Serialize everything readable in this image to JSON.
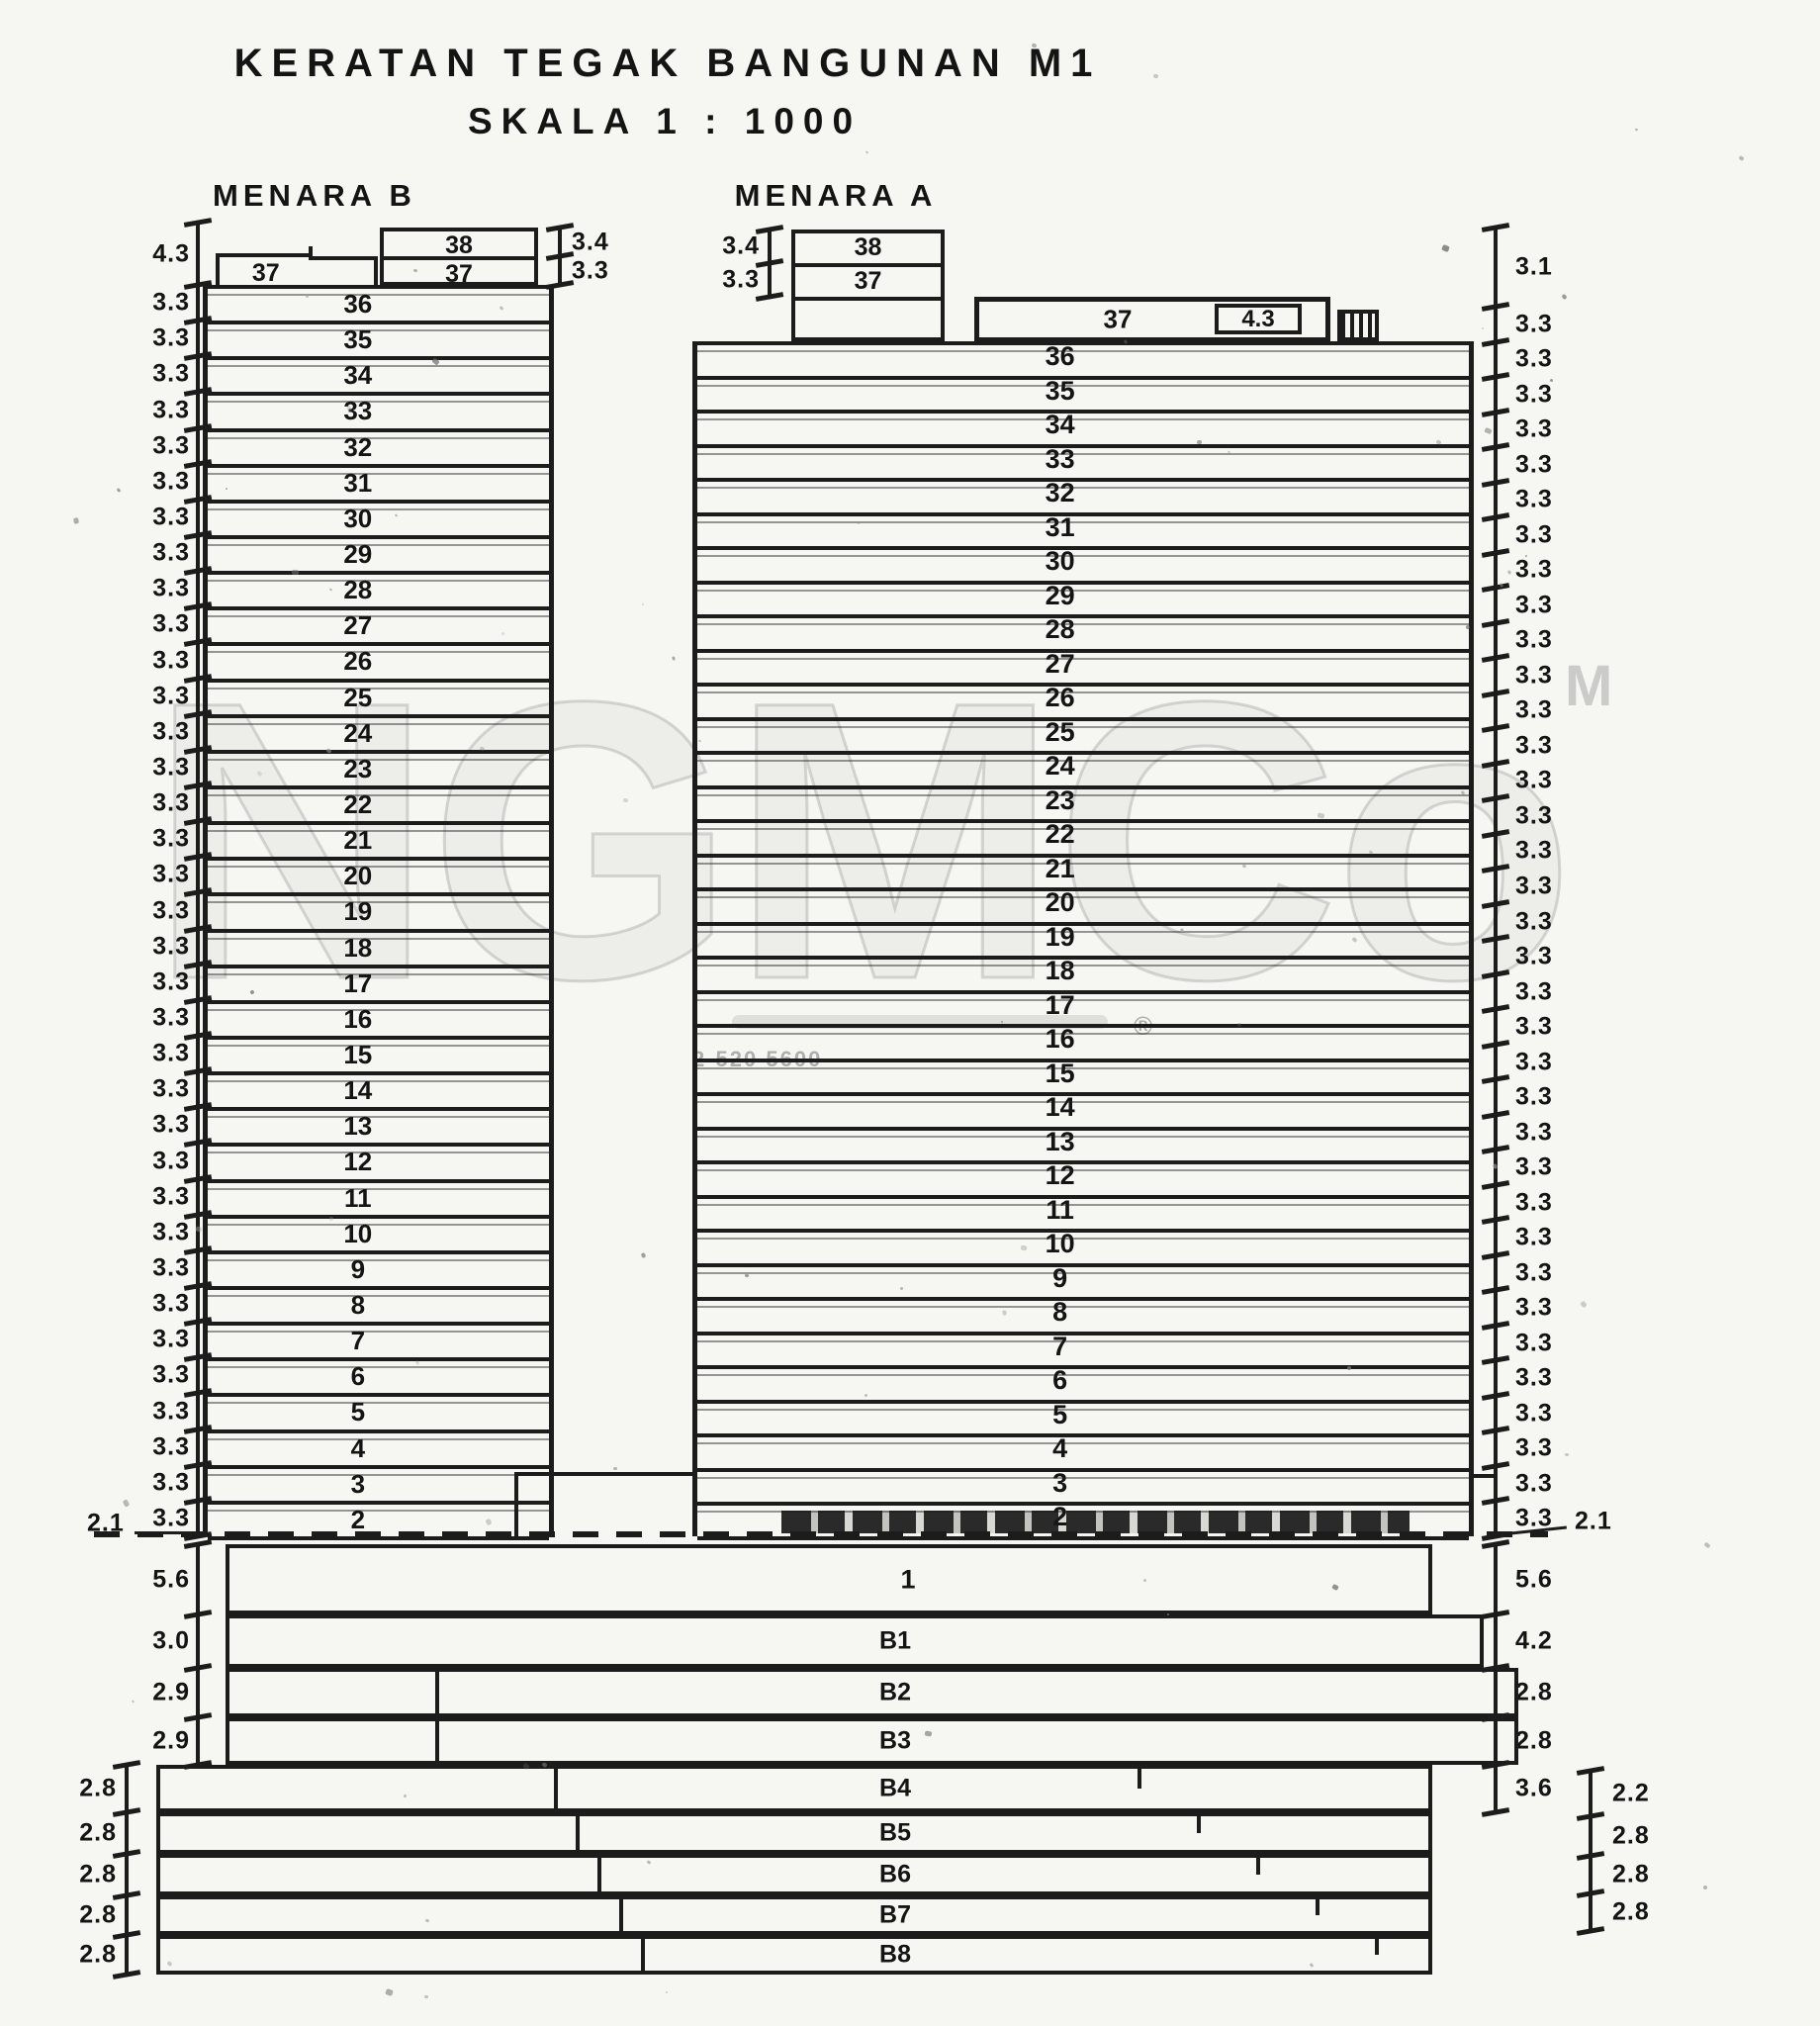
{
  "title": {
    "line1": "KERATAN TEGAK BANGUNAN M1",
    "line2": "SKALA 1 : 1000"
  },
  "tower_b": {
    "label": "MENARA B",
    "roof_label": "37",
    "penthouse": [
      "38",
      "37"
    ],
    "penthouse_dims": [
      "3.4",
      "3.3"
    ],
    "floors": [
      "36",
      "35",
      "34",
      "33",
      "32",
      "31",
      "30",
      "29",
      "28",
      "27",
      "26",
      "25",
      "24",
      "23",
      "22",
      "21",
      "20",
      "19",
      "18",
      "17",
      "16",
      "15",
      "14",
      "13",
      "12",
      "11",
      "10",
      "9",
      "8",
      "7",
      "6",
      "5",
      "4",
      "3",
      "2"
    ]
  },
  "tower_a": {
    "label": "MENARA A",
    "roof_label": "37",
    "roof_dim": "4.3",
    "penthouse": [
      "38",
      "37"
    ],
    "penthouse_dims": [
      "3.4",
      "3.3"
    ],
    "floors": [
      "36",
      "35",
      "34",
      "33",
      "32",
      "31",
      "30",
      "29",
      "28",
      "27",
      "26",
      "25",
      "24",
      "23",
      "22",
      "21",
      "20",
      "19",
      "18",
      "17",
      "16",
      "15",
      "14",
      "13",
      "12",
      "11",
      "10",
      "9",
      "8",
      "7",
      "6",
      "5",
      "4",
      "3",
      "2"
    ]
  },
  "ground_floor_label": "1",
  "basement_floors": [
    "B1",
    "B2",
    "B3",
    "B4",
    "B5",
    "B6",
    "B7",
    "B8"
  ],
  "dims": {
    "left_column": [
      "4.3",
      "3.3",
      "3.3",
      "3.3",
      "3.3",
      "3.3",
      "3.3",
      "3.3",
      "3.3",
      "3.3",
      "3.3",
      "3.3",
      "3.3",
      "3.3",
      "3.3",
      "3.3",
      "3.3",
      "3.3",
      "3.3",
      "3.3",
      "3.3",
      "3.3",
      "3.3",
      "3.3",
      "3.3",
      "3.3",
      "3.3",
      "3.3",
      "3.3",
      "3.3",
      "3.3",
      "3.3",
      "3.3",
      "3.3",
      "3.3",
      "3.3"
    ],
    "left_ground_offset": "2.1",
    "left_below": [
      "5.6",
      "3.0",
      "2.9",
      "2.9"
    ],
    "left_bottom_bracket": [
      "2.8",
      "2.8",
      "2.8",
      "2.8",
      "2.8"
    ],
    "right_column": [
      "3.1",
      "3.3",
      "3.3",
      "3.3",
      "3.3",
      "3.3",
      "3.3",
      "3.3",
      "3.3",
      "3.3",
      "3.3",
      "3.3",
      "3.3",
      "3.3",
      "3.3",
      "3.3",
      "3.3",
      "3.3",
      "3.3",
      "3.3",
      "3.3",
      "3.3",
      "3.3",
      "3.3",
      "3.3",
      "3.3",
      "3.3",
      "3.3",
      "3.3",
      "3.3",
      "3.3",
      "3.3",
      "3.3",
      "3.3",
      "3.3",
      "3.3"
    ],
    "right_ground_offset": "2.1",
    "right_below": [
      "5.6",
      "4.2",
      "2.8",
      "2.8",
      "3.6"
    ],
    "right_bottom_bracket": [
      "2.2",
      "2.8",
      "2.8",
      "2.8"
    ]
  },
  "watermark": {
    "big_letters": "NGMCo",
    "corner_letter": "M",
    "registered_mark": "®",
    "phone_number": "2-520 5600"
  }
}
